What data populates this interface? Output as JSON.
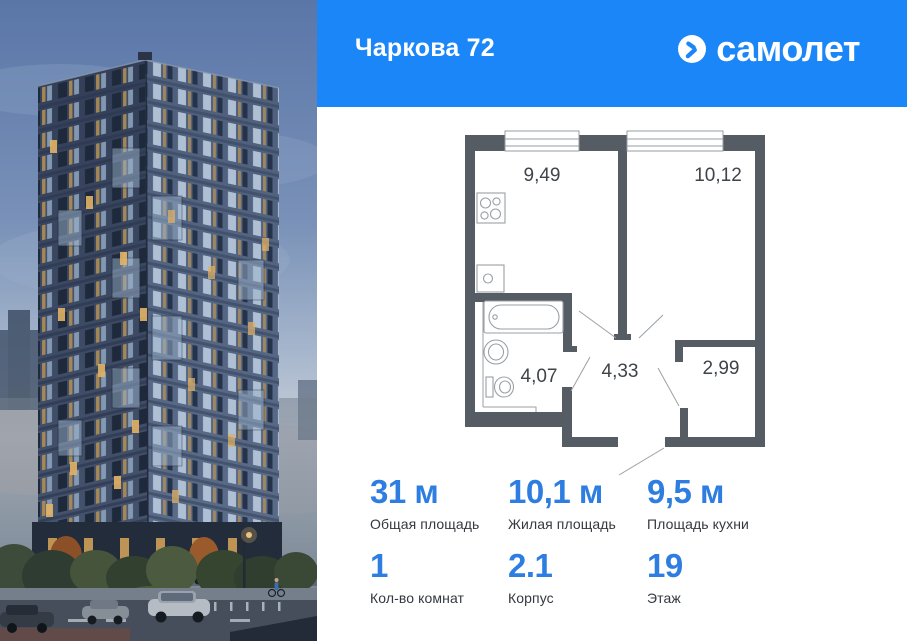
{
  "header": {
    "title": "Чаркова 72",
    "brand": "самолет"
  },
  "floor_plan": {
    "rooms": [
      {
        "id": "kitchen",
        "area": "9,49"
      },
      {
        "id": "living",
        "area": "10,12"
      },
      {
        "id": "bathroom",
        "area": "4,07"
      },
      {
        "id": "hallway",
        "area": "4,33"
      },
      {
        "id": "closet",
        "area": "2,99"
      }
    ]
  },
  "stats": {
    "primary": [
      {
        "value": "31 м",
        "label": "Общая площадь"
      },
      {
        "value": "10,1 м",
        "label": "Жилая площадь"
      },
      {
        "value": "9,5 м",
        "label": "Площадь кухни"
      }
    ],
    "secondary": [
      {
        "value": "1",
        "label": "Кол-во комнат"
      },
      {
        "value": "2.1",
        "label": "Корпус"
      },
      {
        "value": "19",
        "label": "Этаж"
      }
    ]
  },
  "colors": {
    "header_blue": "#1a86f8",
    "value_blue": "#2e7de0",
    "wall_gray": "#565c63",
    "plan_line_gray": "#9aa0a6",
    "label_gray": "#34393f"
  }
}
